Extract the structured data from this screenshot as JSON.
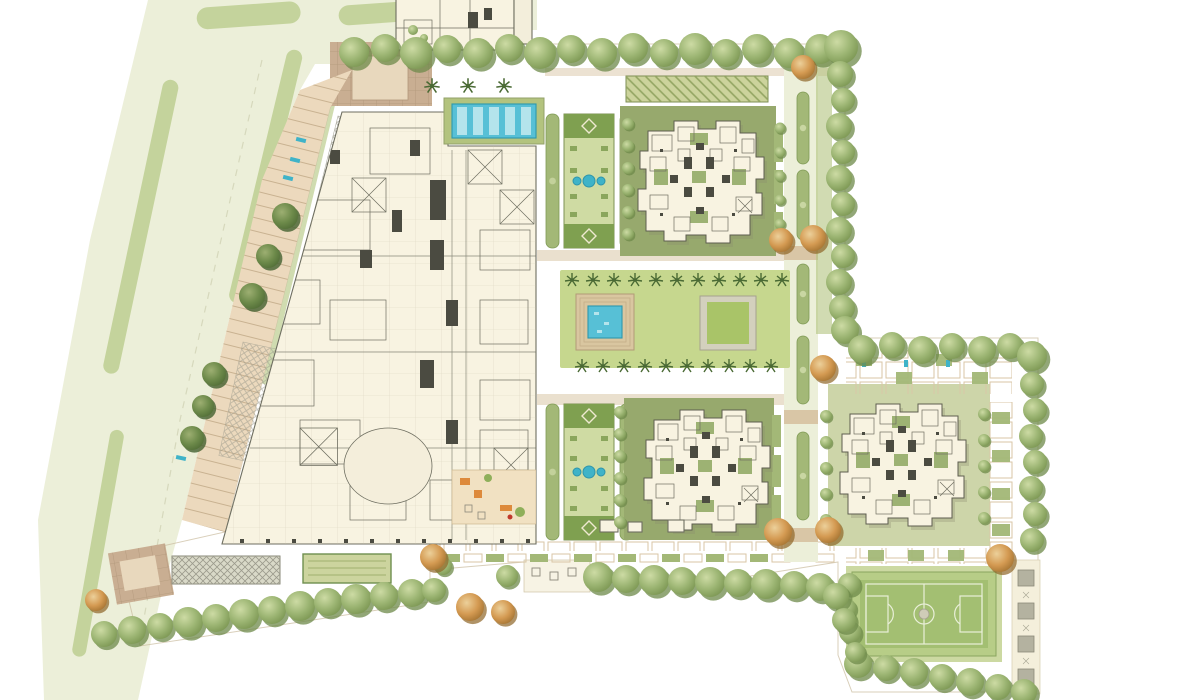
{
  "meta": {
    "type": "architectural-site-plan",
    "view": "top-down rendered master plan",
    "text_labels_visible": 0
  },
  "palette": {
    "page_bg": "#ffffff",
    "road": "#ecefd9",
    "road_median": "#c4d39c",
    "parking": "#ecd9bd",
    "parking_line": "#c5ae8c",
    "plaza_brown": "#c9ae92",
    "plaza_grid": "#b1977a",
    "site_paving": "#efe4cc",
    "paving_accent": "#d9c6a6",
    "building_fill": "#f8f3e1",
    "building_line": "#6e6e60",
    "building_dark": "#4b4b41",
    "pool_water": "#57c0d6",
    "pool_light": "#b4e4ec",
    "deck_green": "#b3c37e",
    "lawn": "#c6d78e",
    "lawn_dark": "#9db273",
    "hedge": "#a3b877",
    "hedge_dark": "#7f9a55",
    "olive_ground": "#97a96d",
    "court_green": "#a3bf72",
    "court_dark": "#8fb061",
    "court_line": "#e9efd8",
    "gray_hatch": "#9b9a8c",
    "teal_accent": "#3fb3c8",
    "outline": "#c9bb9d"
  },
  "features": {
    "boulevard": {
      "label": "tree-lined boulevard with planted medians",
      "median_strips": 5
    },
    "parking_bay": {
      "label": "angled surface parking bay",
      "shade_trees": 6,
      "teal_markers": 5
    },
    "entry_plaza_north": {
      "label": "north entry plaza"
    },
    "entry_plaza_south": {
      "label": "south entry plaza"
    },
    "clubhouse": {
      "label": "clubhouse and podium floor plan",
      "oval_hall": 1,
      "furnished_courtyard": 1
    },
    "north_building": {
      "label": "building footprint cut by top edge"
    },
    "lap_pool": {
      "label": "lap pool on green deck",
      "lanes": 5
    },
    "parterre_north": {
      "label": "formal parterre garden",
      "fountain_jets": 3,
      "diamond_panels": 2
    },
    "parterre_south": {
      "label": "formal parterre garden",
      "fountain_jets": 3,
      "diamond_panels": 2
    },
    "great_lawn": {
      "label": "central great lawn court",
      "palms_north_row": 11,
      "palms_south_row": 10
    },
    "plunge_pool": {
      "label": "sunken square pool"
    },
    "sunken_lawn": {
      "label": "sunken lawn terrace"
    },
    "tower_ne": {
      "label": "residential tower unit-plan cluster"
    },
    "tower_south": {
      "label": "residential tower unit-plan cluster"
    },
    "tower_east": {
      "label": "residential tower unit-plan cluster"
    },
    "towers_total": 3,
    "shade_structure": {
      "label": "hatched shade / deck strip"
    },
    "pergola_gray": {
      "label": "trellised walkway strip"
    },
    "green_court_west": {
      "label": "striped lawn court"
    },
    "seating_terrace": {
      "label": "outdoor seating terrace",
      "tables": 3
    },
    "planter_band": {
      "label": "planter promenade band"
    },
    "east_road": {
      "label": "internal road with median planters",
      "median_segments": 5
    },
    "sports_court": {
      "label": "basketball court"
    },
    "paver_walk": {
      "label": "stepping paver walk",
      "pavers": 4
    },
    "tree_rows": {
      "label": "perimeter tree rows",
      "autumn_accent_trees": 11
    }
  }
}
